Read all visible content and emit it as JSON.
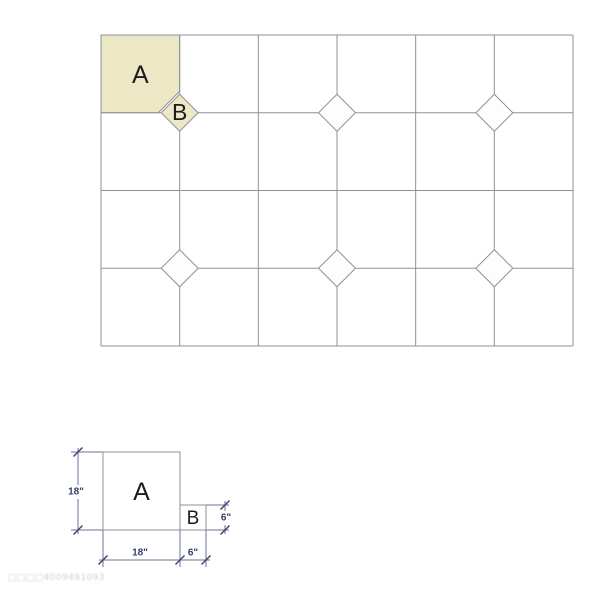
{
  "watermark": {
    "text": "□□□□4009491093",
    "color": "#c9c9c9"
  },
  "pattern_grid": {
    "x": 101,
    "y": 35,
    "width": 472,
    "height": 311,
    "columns": 6,
    "rows": 4,
    "line_color": "#8f8f9a",
    "label_color": "#1c1c1c",
    "accent_fill": "#ece8c6",
    "diamond_fill": "#fdfdfe",
    "diamond_half_diagonal": 18.5,
    "tile_a": {
      "label": "A",
      "col": 0,
      "row": 0,
      "fill": "#ece8c6",
      "notch_radius": 21.5
    },
    "diamonds": [
      {
        "col": 1,
        "row": 1,
        "accent": true,
        "label": "B"
      },
      {
        "col": 3,
        "row": 1,
        "accent": false
      },
      {
        "col": 5,
        "row": 1,
        "accent": false
      },
      {
        "col": 1,
        "row": 3,
        "accent": false
      },
      {
        "col": 3,
        "row": 3,
        "accent": false
      },
      {
        "col": 5,
        "row": 3,
        "accent": false
      }
    ]
  },
  "dimension_diagram": {
    "outline_color": "#8f8f9a",
    "dim_line_color": "#6a7194",
    "tick_color": "#39426e",
    "label_color": "#343d6b",
    "letter_color": "#1c1c1c",
    "squares": [
      {
        "name": "detail-square-a",
        "label": "A",
        "x": 103,
        "y": 452,
        "width": 77,
        "height": 78,
        "font": 25
      },
      {
        "name": "detail-square-b",
        "label": "B",
        "x": 180,
        "y": 505,
        "width": 26,
        "height": 25,
        "font": 19
      }
    ],
    "extension_lines": [
      [
        71,
        452,
        103,
        452
      ],
      [
        71,
        530,
        103,
        530
      ],
      [
        206,
        505,
        229,
        505
      ],
      [
        206,
        530,
        229,
        530
      ],
      [
        103,
        530,
        103,
        567
      ],
      [
        180,
        530,
        180,
        567
      ],
      [
        206,
        530,
        206,
        567
      ]
    ],
    "dimension_lines": [
      [
        78,
        448,
        78,
        534
      ],
      [
        225,
        501,
        225,
        534
      ],
      [
        99,
        560,
        210,
        560
      ]
    ],
    "ticks": [
      [
        78,
        452
      ],
      [
        78,
        530
      ],
      [
        225,
        505
      ],
      [
        225,
        530
      ],
      [
        103,
        560
      ],
      [
        180,
        560
      ],
      [
        206,
        560
      ]
    ],
    "labels": [
      {
        "text": "18\"",
        "x": 76,
        "y": 492,
        "bg": true
      },
      {
        "text": "6\"",
        "x": 226,
        "y": 518,
        "bg": true
      },
      {
        "text": "18\"",
        "x": 140,
        "y": 553,
        "bg": false
      },
      {
        "text": "6\"",
        "x": 193,
        "y": 553,
        "bg": false
      }
    ]
  }
}
